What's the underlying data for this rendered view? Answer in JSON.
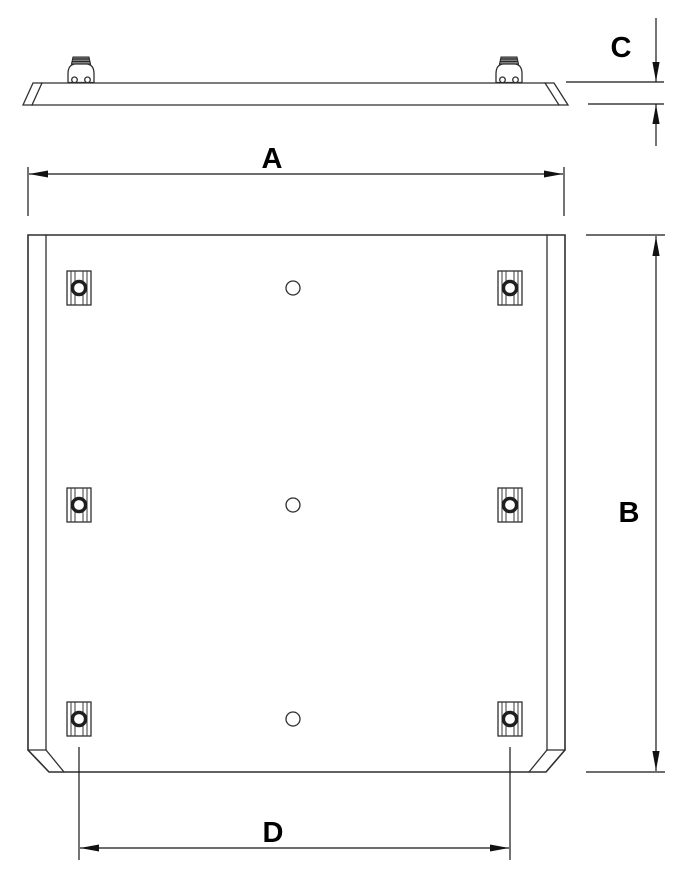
{
  "drawing": {
    "views": {
      "side_view_name": "panel-side-profile",
      "front_view_name": "panel-front-face"
    },
    "dimensions": {
      "a": {
        "label": "A"
      },
      "b": {
        "label": "B"
      },
      "c": {
        "label": "C"
      },
      "d": {
        "label": "D"
      }
    },
    "features": {
      "mounting_bracket_count": 6,
      "center_hole_count": 3,
      "spring_clip_count": 2
    },
    "colors": {
      "background": "#ffffff",
      "line": "#2f2f2f",
      "dimension_line": "#161616",
      "label_text": "#000000",
      "clip_cap_fill": "#8c8c8c"
    }
  }
}
